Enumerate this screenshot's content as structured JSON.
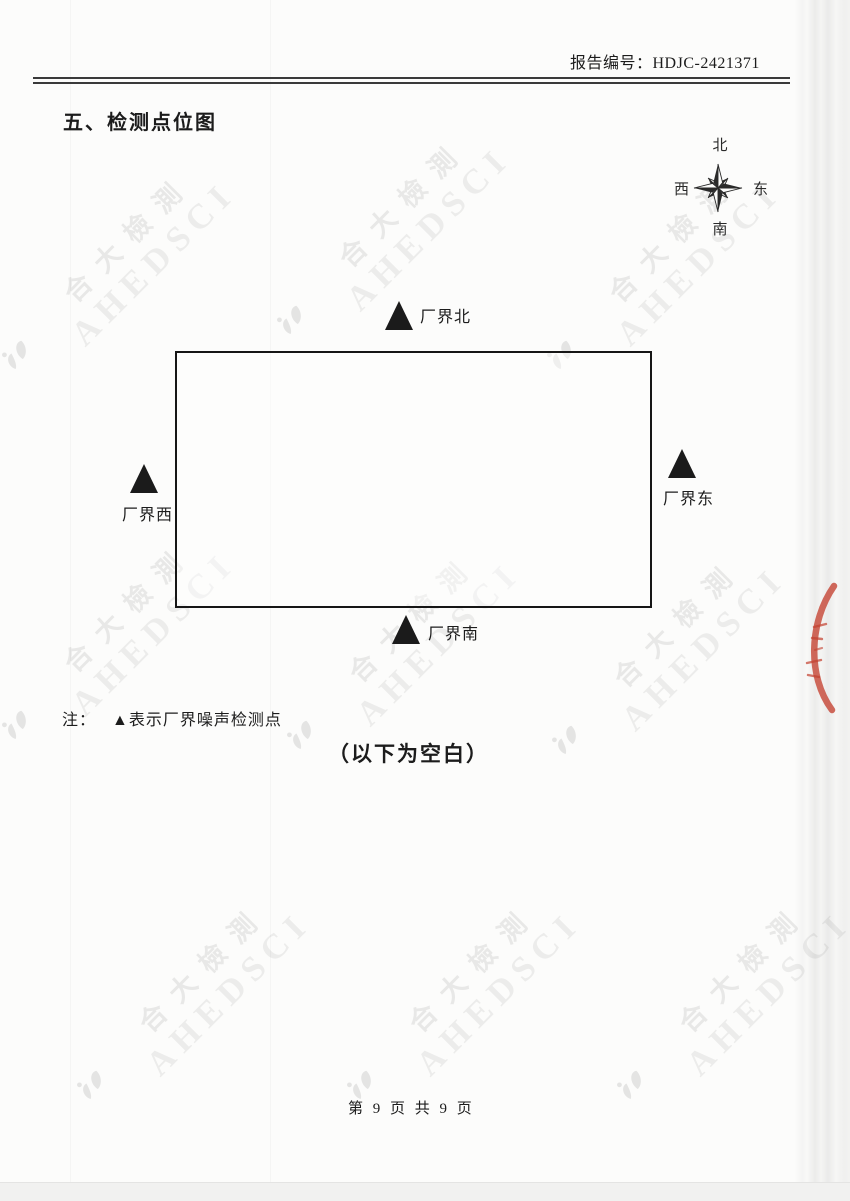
{
  "header": {
    "report_number_label": "报告编号：HDJC-2421371"
  },
  "section": {
    "title": "五、检测点位图"
  },
  "compass": {
    "north": "北",
    "south": "南",
    "east": "东",
    "west": "西"
  },
  "diagram": {
    "markers": {
      "north": {
        "label": "厂界北"
      },
      "east": {
        "label": "厂界东"
      },
      "west": {
        "label": "厂界西"
      },
      "south": {
        "label": "厂界南"
      }
    },
    "note_prefix": "注：",
    "note_text": "▲表示厂界噪声检测点",
    "blank_note": "（以下为空白）"
  },
  "watermark": {
    "latin": "AHEDSCI",
    "cjk": "合大檢測"
  },
  "footer": {
    "page_indicator": "第 9 页 共 9 页"
  },
  "colors": {
    "ink": "#1c1c1c",
    "stamp_red": "#c4402f",
    "paper": "#fcfcfb"
  }
}
